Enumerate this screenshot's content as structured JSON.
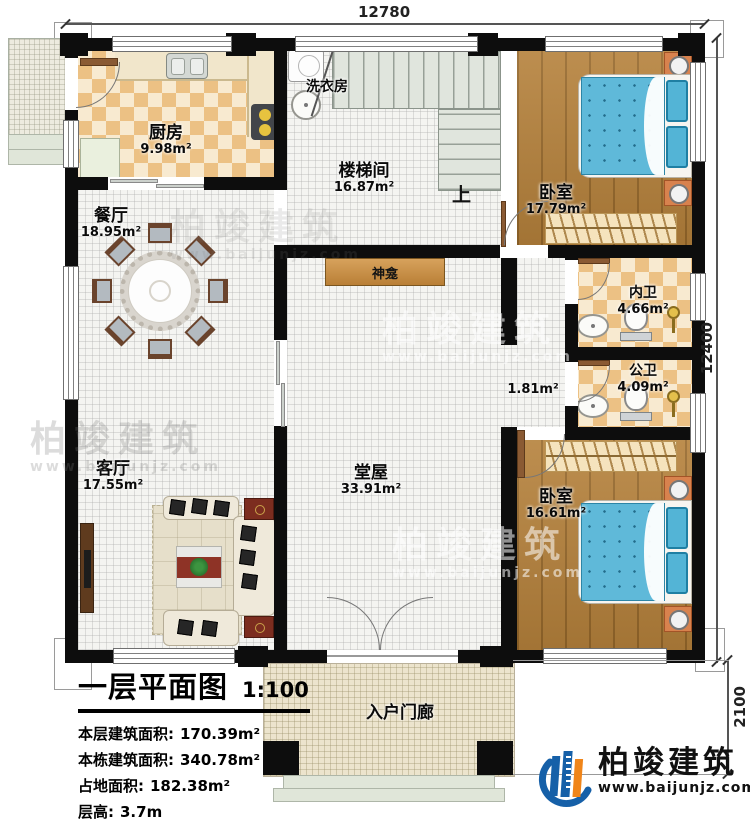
{
  "dimensions": {
    "top": "12780",
    "right": "12400",
    "porch_depth": "2100"
  },
  "rooms": {
    "kitchen": {
      "name": "厨房",
      "area": "9.98m²"
    },
    "laundry": {
      "name": "洗衣房"
    },
    "stairwell": {
      "name": "楼梯间",
      "area": "16.87m²",
      "direction": "上"
    },
    "bedroom_top": {
      "name": "卧室",
      "area": "17.79m²"
    },
    "dining": {
      "name": "餐厅",
      "area": "18.95m²"
    },
    "shrine": {
      "name": "神龛"
    },
    "hall": {
      "name": "堂屋",
      "area": "33.91m²"
    },
    "corridor": {
      "area": "1.81m²"
    },
    "bath_inner": {
      "name": "内卫",
      "area": "4.66m²"
    },
    "bath_public": {
      "name": "公卫",
      "area": "4.09m²"
    },
    "bedroom_bottom": {
      "name": "卧室",
      "area": "16.61m²"
    },
    "living": {
      "name": "客厅",
      "area": "17.55m²"
    },
    "porch": {
      "name": "入户门廊"
    }
  },
  "title_block": {
    "title": "一层平面图",
    "scale": "1:100",
    "rows": [
      {
        "label": "本层建筑面积:",
        "value": "170.39m²"
      },
      {
        "label": "本栋建筑面积:",
        "value": "340.78m²"
      },
      {
        "label": "占地面积:",
        "value": "182.38m²"
      },
      {
        "label": "层高:",
        "value": "3.7m"
      }
    ]
  },
  "brand": {
    "name": "柏竣建筑",
    "url": "www.baijunjz.com"
  },
  "watermark": {
    "name": "柏竣建筑",
    "url": "www.baijunjz.com"
  },
  "colors": {
    "wall": "#0d0d0d",
    "wood": "#b5813b",
    "checker": "#ecc184",
    "bed_blue": "#5fb9d9",
    "brand_blue": "#1660a8",
    "brand_orange": "#f08519"
  }
}
